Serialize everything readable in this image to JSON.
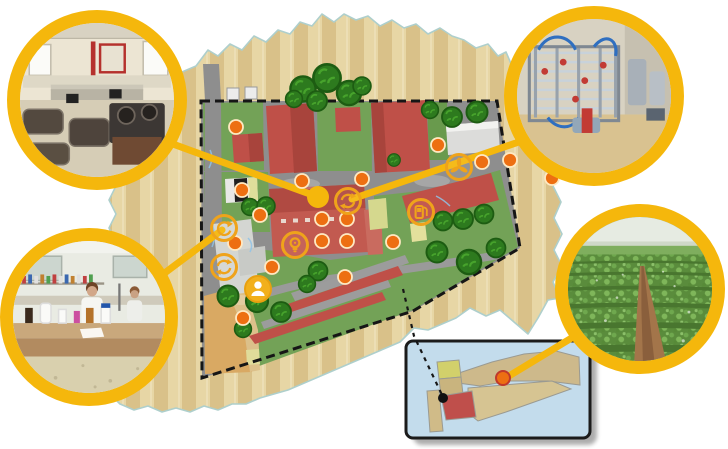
{
  "map": {
    "description": "illustrated-campus-site-map-with-photo-callouts",
    "colors": {
      "accent_yellow": "#F5B70C",
      "icon_ring_yellow": "#EFA31B",
      "marker_orange": "#ED6F12",
      "marker_rim": "#FFE9C2",
      "building_red": "#BF5048",
      "lawn_green": "#73A257",
      "road_gray": "#8E8E8E",
      "farmland_beige": "#E7D6A5",
      "farmland_stripe": "#D9C189",
      "boundary_black": "#161616",
      "inset_blue": "#C3DCEC",
      "inset_red_parcel": "#BF4F4B",
      "tan_zone": "#D9A963"
    },
    "markers": [
      [
        236,
        127
      ],
      [
        242,
        190
      ],
      [
        302,
        181
      ],
      [
        362,
        179
      ],
      [
        438,
        145
      ],
      [
        482,
        162
      ],
      [
        510,
        160
      ],
      [
        552,
        178
      ],
      [
        260,
        215
      ],
      [
        235,
        243
      ],
      [
        272,
        267
      ],
      [
        322,
        219
      ],
      [
        347,
        219
      ],
      [
        322,
        241
      ],
      [
        347,
        241
      ],
      [
        345,
        277
      ],
      [
        243,
        318
      ],
      [
        393,
        242
      ]
    ],
    "featured_marker": {
      "x": 318,
      "y": 197,
      "r": 11
    },
    "icon_hotspots": [
      {
        "x": 348,
        "y": 201,
        "icon": "refresh-icon"
      },
      {
        "x": 295,
        "y": 245,
        "icon": "lightbulb-icon"
      },
      {
        "x": 224,
        "y": 228,
        "icon": "rotate-icon"
      },
      {
        "x": 224,
        "y": 267,
        "icon": "refresh-icon"
      },
      {
        "x": 258,
        "y": 289,
        "icon": "person-icon",
        "filled": true
      },
      {
        "x": 459,
        "y": 167,
        "icon": "pinwheel-icon"
      },
      {
        "x": 421,
        "y": 212,
        "icon": "fuel-pump-icon"
      }
    ],
    "trees": [
      [
        303,
        89,
        1.2
      ],
      [
        327,
        78,
        1.3
      ],
      [
        349,
        93,
        1.15
      ],
      [
        317,
        101,
        0.95
      ],
      [
        294,
        99,
        0.8
      ],
      [
        362,
        86,
        0.85
      ],
      [
        452,
        117,
        0.95
      ],
      [
        477,
        112,
        1.0
      ],
      [
        430,
        110,
        0.8
      ],
      [
        250,
        207,
        0.8
      ],
      [
        266,
        206,
        0.85
      ],
      [
        228,
        296,
        1.0
      ],
      [
        257,
        301,
        1.05
      ],
      [
        281,
        312,
        0.95
      ],
      [
        243,
        329,
        0.8
      ],
      [
        318,
        271,
        0.9
      ],
      [
        307,
        284,
        0.8
      ],
      [
        394,
        160,
        0.6
      ],
      [
        443,
        221,
        0.9
      ],
      [
        463,
        219,
        0.95
      ],
      [
        484,
        214,
        0.9
      ],
      [
        437,
        252,
        1.0
      ],
      [
        469,
        262,
        1.15
      ],
      [
        496,
        248,
        0.9
      ]
    ],
    "connectors": [
      {
        "name": "test-kitchen",
        "x1": 140,
        "y1": 132,
        "x2": 318,
        "y2": 197
      },
      {
        "name": "pilot-plant",
        "x1": 548,
        "y1": 132,
        "x2": 352,
        "y2": 199
      },
      {
        "name": "laboratory",
        "x1": 138,
        "y1": 293,
        "x2": 222,
        "y2": 230
      },
      {
        "name": "crop-field",
        "x1": 598,
        "y1": 322,
        "x2": 504,
        "y2": 379
      }
    ],
    "locator": {
      "path": [
        [
          403,
          289
        ],
        [
          414,
          336
        ],
        [
          443,
          397
        ]
      ],
      "black_dot": {
        "x": 443,
        "y": 398,
        "r": 5
      },
      "inset_marker": {
        "x": 503,
        "y": 378,
        "r": 7
      }
    },
    "callouts": [
      {
        "name": "test-kitchen",
        "photo": "industrial-test-kitchen-interior",
        "x": 7,
        "y": 10,
        "size": 180
      },
      {
        "name": "pilot-plant",
        "photo": "stainless-steel-processing-pilot-plant",
        "x": 504,
        "y": 6,
        "size": 180
      },
      {
        "name": "laboratory",
        "photo": "analysis-laboratory-with-technicians",
        "x": 0,
        "y": 228,
        "size": 178
      },
      {
        "name": "crop-field",
        "photo": "green-crop-field",
        "x": 555,
        "y": 204,
        "size": 170
      }
    ]
  }
}
